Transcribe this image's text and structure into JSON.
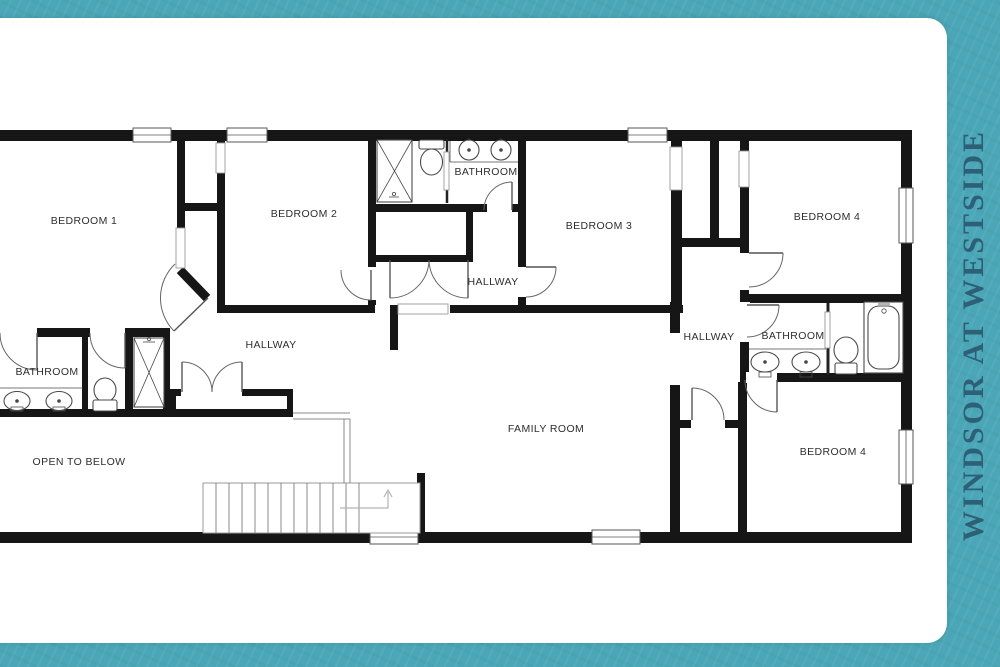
{
  "title": "WINDSOR AT WESTSIDE",
  "colors": {
    "frame_teal": "#4BA7B7",
    "title_text": "#2D6077",
    "walls": "#161616",
    "labels": "#2e2e2e"
  },
  "floorplan": {
    "rooms": [
      {
        "id": "bedroom-1",
        "label": "BEDROOM 1"
      },
      {
        "id": "bedroom-2",
        "label": "BEDROOM 2"
      },
      {
        "id": "bathroom-top",
        "label": "BATHROOM"
      },
      {
        "id": "hallway-top",
        "label": "HALLWAY"
      },
      {
        "id": "bedroom-3",
        "label": "BEDROOM 3"
      },
      {
        "id": "bedroom-4-top",
        "label": "BEDROOM 4"
      },
      {
        "id": "hallway-left",
        "label": "HALLWAY"
      },
      {
        "id": "hallway-right",
        "label": "HALLWAY"
      },
      {
        "id": "bathroom-right",
        "label": "BATHROOM"
      },
      {
        "id": "bathroom-left",
        "label": "BATHROOM"
      },
      {
        "id": "open-to-below",
        "label": "OPEN TO BELOW"
      },
      {
        "id": "family-room",
        "label": "FAMILY ROOM"
      },
      {
        "id": "bedroom-4-bottom",
        "label": "BEDROOM 4"
      }
    ]
  }
}
